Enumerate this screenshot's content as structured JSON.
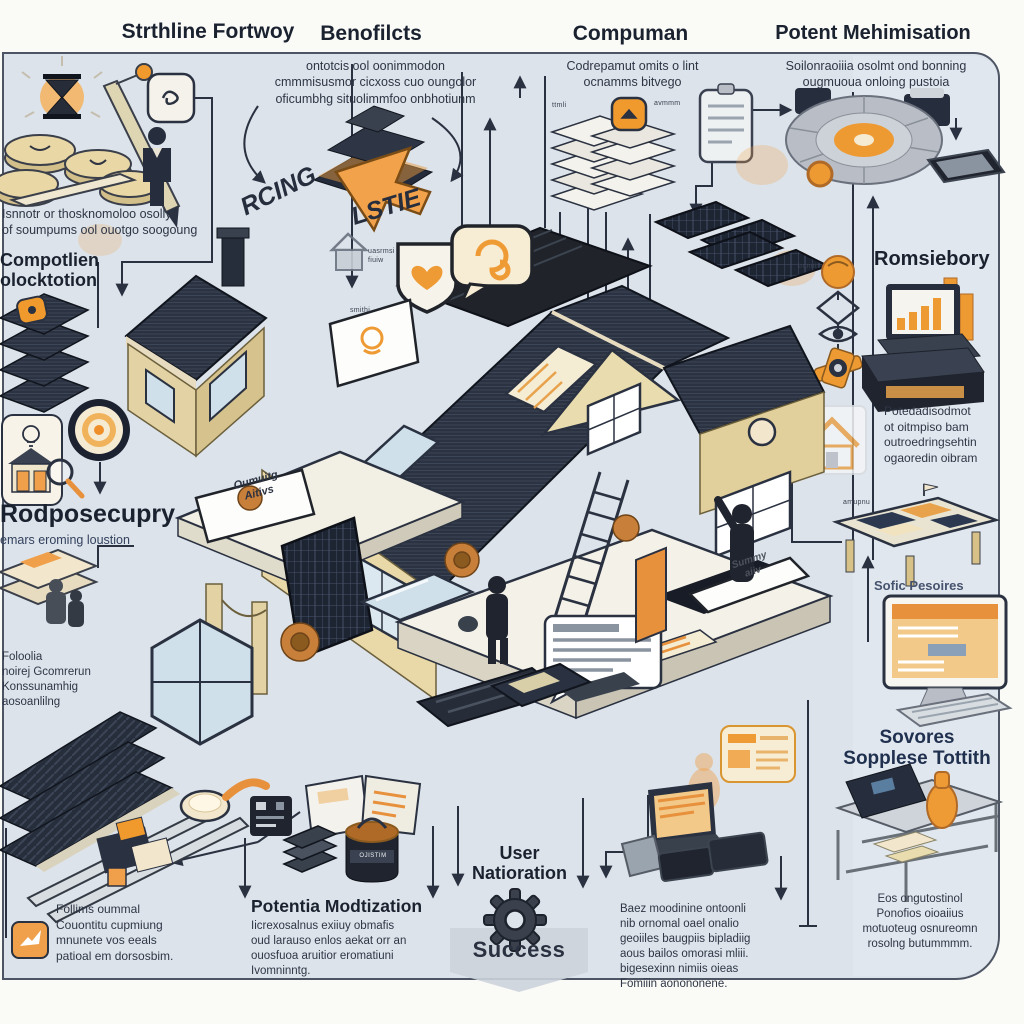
{
  "colors": {
    "panel_bg": "#dce3ea",
    "panel_border": "#4d5564",
    "ink": "#232b3a",
    "roof_slate": "#2a3240",
    "wall_cream": "#ead9a8",
    "wall_tan": "#d8c186",
    "accent_orange": "#ef9b35",
    "paper_cream": "#f2e7cd",
    "glass_blue": "#cfe0ea"
  },
  "headings": {
    "streamline": "Strthline Fortwoy",
    "benefits": "Benofilcts",
    "compman": "Compuman",
    "potent": "Potent Mehimisation"
  },
  "captions": {
    "benefits": "ontotcis ool oonimmodon\ncmmmisusmor cicxoss cuo oungolor\noficumbhg situolimmfoo onbhotiunm",
    "compman": "Codrepamut omits o lint\nocnamms bitvego",
    "potent": "Soilonraoiiia osolmt ond bonning\nougmuoua onloing pustoia",
    "streamline": "Isnnotr or thosknomoloo osolly\nof soumpums ool ouotgo soogoung",
    "rodpose": "emars eroming loustion",
    "left_mid": "Foloolia\nnoirej Gcomrerun\nKonssunamhig\naosoanlilng",
    "bottom_left": "Follims oummal\nCouontitu cupmiung\nmnunete vos eeals\npatioal em dorsosbim.",
    "potentia": "Iicrexosalnus exiiuy obmafis\noud larauso enlos aekat orr an\nouosfuoa aruitior eromatiuni\nIvomninntg.",
    "bottom_right": "Baez moodinine ontoonli\nnib ornomal oael onalio\ngeoiiles baugpiis bipladiig\naous bailos omorasi mliii.\nbigesexinn nimiis oieas\nFomiiin aonononene.",
    "romsiebory": "Potedadisodmot\not oitmpiso bam\noutroedringsehtin\nogaoredin oibram",
    "machine": "Eos ongutostinol\nPonofios oioaiius\nmotuoteug osnureomn\nrosolng butummmm."
  },
  "labels": {
    "composition": "Compotlien\nolocktotion",
    "rodpose": "Rodposecupry",
    "potentia": "Potentia Modtization",
    "user_navigation": "User\nNatioration",
    "success": "Success",
    "romsiebory": "Romsiebory",
    "soft_resources": "Sofic Pesoires",
    "sovores": "Sovores\nSopplese Tottith",
    "ricing": "RCING",
    "lstie": "LSTIE",
    "porch_sign": "Oumuitg\nAitivs",
    "floor_sign": "Summy\naiiv",
    "canister": "OJISTIM"
  },
  "tiny_labels": {
    "pyramid": "uasrmsi\nfiuiw",
    "house": "smithi",
    "stack": "ttmli",
    "clip": "avmmm",
    "right_col": "tnomt",
    "table": "amupnu"
  },
  "icons": {
    "gear": "success gear",
    "target": "bullseye target",
    "shield_heart": "shield badge with heart",
    "speech_bubble": "speech bubble with swirl",
    "cursor": "orange mouse cursor",
    "location_pin": "orange location pin",
    "lightbulb": "idea bulb",
    "magnifier": "magnifying glass",
    "person": "person silhouette",
    "clipboard": "clipboard document",
    "eye": "eye outline",
    "diamond": "diamond outline",
    "valve": "orange pipe valve",
    "bird": "bird badge",
    "qr_patch": "dark qr patch",
    "spoon": "spoon with cream",
    "ladder": "ladder",
    "solar_panel": "solar panel array",
    "robot_disc": "round robot disc"
  }
}
